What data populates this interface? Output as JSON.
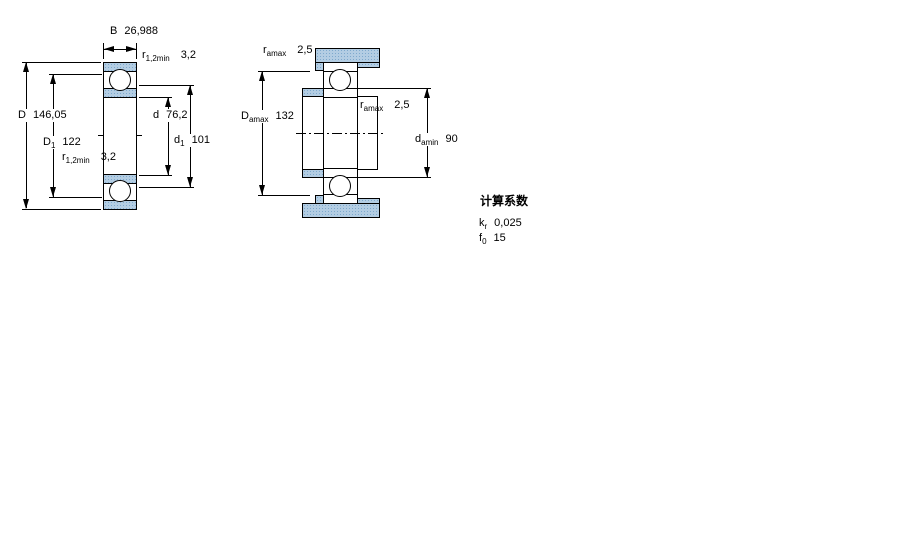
{
  "colors": {
    "line": "#000000",
    "section_fill": "#b3cde3",
    "section_dot": "#7ea9cd",
    "background": "#ffffff"
  },
  "left_figure": {
    "description": "bearing cross-section with boundary dimensions",
    "dims": {
      "B": {
        "symbol": "B",
        "sub": "",
        "value": "26,988"
      },
      "D": {
        "symbol": "D",
        "sub": "",
        "value": "146,05"
      },
      "D1": {
        "symbol": "D",
        "sub": "1",
        "value": "122"
      },
      "d": {
        "symbol": "d",
        "sub": "",
        "value": "76,2"
      },
      "d1": {
        "symbol": "d",
        "sub": "1",
        "value": "101"
      },
      "r_top": {
        "symbol": "r",
        "sub": "1,2min",
        "value": "3,2"
      },
      "r_bottom": {
        "symbol": "r",
        "sub": "1,2min",
        "value": "3,2"
      }
    }
  },
  "right_figure": {
    "description": "mounted bearing with shaft and housing abutment dimensions",
    "dims": {
      "r_top": {
        "symbol": "r",
        "sub": "amax",
        "value": "2,5"
      },
      "Damax": {
        "symbol": "D",
        "sub": "amax",
        "value": "132"
      },
      "r_mid": {
        "symbol": "r",
        "sub": "amax",
        "value": "2,5"
      },
      "damin": {
        "symbol": "d",
        "sub": "amin",
        "value": "90"
      }
    }
  },
  "calculation_factors": {
    "heading": "计算系数",
    "rows": [
      {
        "symbol": "k",
        "sub": "r",
        "value": "0,025"
      },
      {
        "symbol": "f",
        "sub": "0",
        "value": "15"
      }
    ]
  }
}
